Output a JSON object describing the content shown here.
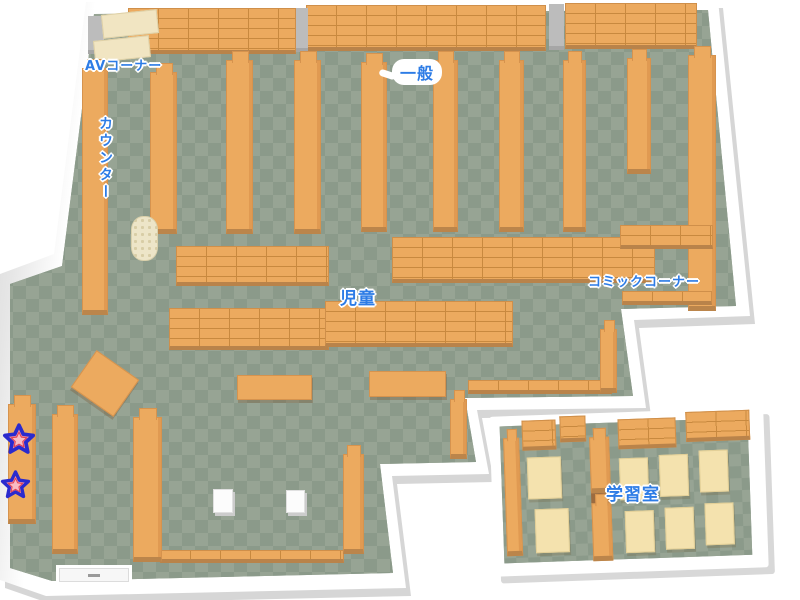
{
  "map": {
    "title": "library-floor-map",
    "colors": {
      "background": "#ffffff",
      "floor_light": "#97a494",
      "floor_dark": "#8b9a8a",
      "wall": "#ffffff",
      "wall_shadow": "#d6d6d6",
      "shelf_orange": "#ecaa5f",
      "shelf_edge": "#c8893f",
      "desk_cream": "#f4e2ae",
      "label_blue": "#2d7ce6",
      "star_pink": "#f5909e",
      "star_outline": "#2a2ace"
    },
    "areas": [
      {
        "id": "av-corner",
        "label": "AVコーナー"
      },
      {
        "id": "general",
        "label": "一般"
      },
      {
        "id": "counter",
        "label": "カウンター"
      },
      {
        "id": "children",
        "label": "児童"
      },
      {
        "id": "comic-corner",
        "label": "コミックコーナー"
      },
      {
        "id": "study-room",
        "label": "学習室"
      }
    ],
    "markers": [
      {
        "id": "star-1",
        "type": "star"
      },
      {
        "id": "star-2",
        "type": "star"
      }
    ],
    "furniture": [
      {
        "type": "wallshelf",
        "x": 128,
        "y": 8,
        "w": 168,
        "h": 46
      },
      {
        "type": "wallshelf",
        "x": 306,
        "y": 5,
        "w": 240,
        "h": 46
      },
      {
        "type": "wallshelf",
        "x": 565,
        "y": 3,
        "w": 132,
        "h": 46
      },
      {
        "type": "pillar",
        "x": 88,
        "y": 16,
        "w": 16,
        "h": 38
      },
      {
        "type": "pillar",
        "x": 296,
        "y": 8,
        "w": 12,
        "h": 44
      },
      {
        "type": "pillar",
        "x": 549,
        "y": 4,
        "w": 15,
        "h": 46
      },
      {
        "type": "creamdesk",
        "x": 102,
        "y": 12,
        "w": 56,
        "h": 24,
        "name": "av-desk"
      },
      {
        "type": "creamdesk",
        "x": 94,
        "y": 38,
        "w": 56,
        "h": 22,
        "name": "av-desk"
      },
      {
        "type": "shelfv",
        "x": 82,
        "y": 68,
        "w": 26,
        "h": 247,
        "name": "counter-desk"
      },
      {
        "type": "shelfv",
        "x": 150,
        "y": 72,
        "w": 27,
        "h": 162
      },
      {
        "type": "shelfv",
        "x": 226,
        "y": 60,
        "w": 27,
        "h": 174
      },
      {
        "type": "shelfv",
        "x": 294,
        "y": 60,
        "w": 27,
        "h": 174
      },
      {
        "type": "shelfv",
        "x": 361,
        "y": 62,
        "w": 26,
        "h": 170
      },
      {
        "type": "shelfv",
        "x": 433,
        "y": 60,
        "w": 25,
        "h": 172
      },
      {
        "type": "shelfv",
        "x": 499,
        "y": 60,
        "w": 25,
        "h": 172
      },
      {
        "type": "shelfv",
        "x": 563,
        "y": 60,
        "w": 23,
        "h": 172
      },
      {
        "type": "shelfv",
        "x": 627,
        "y": 58,
        "w": 24,
        "h": 116
      },
      {
        "type": "shelfv",
        "x": 688,
        "y": 55,
        "w": 28,
        "h": 256
      },
      {
        "type": "cylinder",
        "x": 131,
        "y": 216,
        "w": 27,
        "h": 45
      },
      {
        "type": "wideshelf",
        "x": 176,
        "y": 246,
        "w": 153,
        "h": 40
      },
      {
        "type": "wideshelf",
        "x": 392,
        "y": 237,
        "w": 263,
        "h": 46
      },
      {
        "type": "wideshelf",
        "x": 169,
        "y": 308,
        "w": 160,
        "h": 42
      },
      {
        "type": "wideshelf",
        "x": 325,
        "y": 301,
        "w": 188,
        "h": 46
      },
      {
        "type": "wideshelf",
        "x": 620,
        "y": 225,
        "w": 93,
        "h": 24
      },
      {
        "type": "wideshelf",
        "x": 622,
        "y": 291,
        "w": 90,
        "h": 14
      },
      {
        "type": "wideshelf",
        "x": 468,
        "y": 380,
        "w": 144,
        "h": 14
      },
      {
        "type": "wideshelf",
        "x": 160,
        "y": 550,
        "w": 184,
        "h": 13
      },
      {
        "type": "shelfv",
        "x": 600,
        "y": 329,
        "w": 17,
        "h": 64
      },
      {
        "type": "shelfv",
        "x": 450,
        "y": 399,
        "w": 17,
        "h": 60
      },
      {
        "type": "shelfv",
        "x": 8,
        "y": 404,
        "w": 28,
        "h": 120
      },
      {
        "type": "shelfv",
        "x": 52,
        "y": 414,
        "w": 26,
        "h": 140
      },
      {
        "type": "shelfv",
        "x": 133,
        "y": 417,
        "w": 29,
        "h": 145
      },
      {
        "type": "shelfv",
        "x": 343,
        "y": 454,
        "w": 21,
        "h": 100
      },
      {
        "type": "lowtable",
        "x": 237,
        "y": 375,
        "w": 75,
        "h": 25
      },
      {
        "type": "lowtable",
        "x": 369,
        "y": 371,
        "w": 77,
        "h": 26
      },
      {
        "type": "lowtable",
        "x": 79,
        "y": 361,
        "w": 52,
        "h": 45,
        "rot": 35
      },
      {
        "type": "whitebox",
        "x": 213,
        "y": 489,
        "w": 20,
        "h": 24
      },
      {
        "type": "whitebox",
        "x": 286,
        "y": 490,
        "w": 19,
        "h": 23
      },
      {
        "type": "door",
        "x": 56,
        "y": 565,
        "w": 76,
        "h": 20
      },
      {
        "type": "shelfv",
        "x": 13,
        "y": 22,
        "w": 16,
        "h": 118,
        "room": "study"
      },
      {
        "type": "shelfv",
        "x": 99,
        "y": 24,
        "w": 20,
        "h": 56,
        "room": "study"
      },
      {
        "type": "gap",
        "x": 99,
        "y": 80,
        "w": 20,
        "h": 10,
        "room": "study"
      },
      {
        "type": "shelfv",
        "x": 99,
        "y": 90,
        "w": 20,
        "h": 58,
        "room": "study"
      },
      {
        "type": "wallshelf",
        "x": 32,
        "y": 5,
        "w": 34,
        "h": 30,
        "room": "study"
      },
      {
        "type": "wallshelf",
        "x": 70,
        "y": 2,
        "w": 26,
        "h": 26,
        "room": "study"
      },
      {
        "type": "wallshelf",
        "x": 128,
        "y": 7,
        "w": 58,
        "h": 30,
        "room": "study"
      },
      {
        "type": "wallshelf",
        "x": 196,
        "y": 2,
        "w": 64,
        "h": 30,
        "room": "study"
      },
      {
        "type": "creamtable",
        "x": 36,
        "y": 42,
        "w": 34,
        "h": 42,
        "room": "study"
      },
      {
        "type": "creamtable",
        "x": 42,
        "y": 94,
        "w": 34,
        "h": 44,
        "room": "study"
      },
      {
        "type": "creamtable",
        "x": 128,
        "y": 46,
        "w": 29,
        "h": 42,
        "room": "study"
      },
      {
        "type": "creamtable",
        "x": 168,
        "y": 44,
        "w": 29,
        "h": 42,
        "room": "study"
      },
      {
        "type": "creamtable",
        "x": 208,
        "y": 41,
        "w": 29,
        "h": 42,
        "room": "study"
      },
      {
        "type": "creamtable",
        "x": 132,
        "y": 99,
        "w": 29,
        "h": 42,
        "room": "study"
      },
      {
        "type": "creamtable",
        "x": 172,
        "y": 97,
        "w": 29,
        "h": 42,
        "room": "study"
      },
      {
        "type": "creamtable",
        "x": 212,
        "y": 94,
        "w": 29,
        "h": 42,
        "room": "study"
      }
    ]
  }
}
